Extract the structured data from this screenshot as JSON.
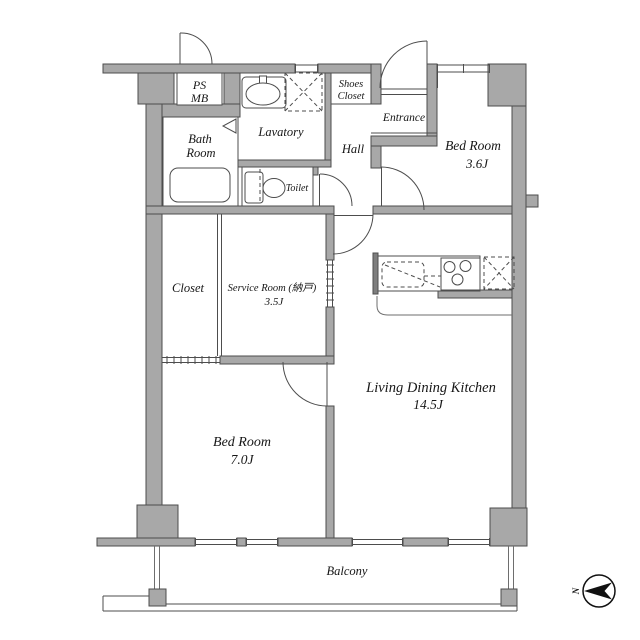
{
  "colors": {
    "wall_fill": "#a8a8a8",
    "wall_edge": "#4d4d4d",
    "counter_bar": "#7e7e7e",
    "text": "#161616",
    "compass": "#111111"
  },
  "rooms": {
    "ps_mb": {
      "line1": "PS",
      "line2": "MB"
    },
    "bath": {
      "line1": "Bath",
      "line2": "Room"
    },
    "lavatory": {
      "label": "Lavatory"
    },
    "shoes_closet": {
      "line1": "Shoes",
      "line2": "Closet"
    },
    "hall": {
      "label": "Hall"
    },
    "entrance": {
      "label": "Entrance"
    },
    "toilet": {
      "label": "Toilet"
    },
    "bedroom_3_6": {
      "line1": "Bed Room",
      "line2": "3.6J"
    },
    "closet": {
      "label": "Closet"
    },
    "service_room": {
      "line1": "Service Room (納戸)",
      "line2": "3.5J"
    },
    "ldk": {
      "line1": "Living Dining Kitchen",
      "line2": "14.5J"
    },
    "bedroom_7_0": {
      "line1": "Bed Room",
      "line2": "7.0J"
    },
    "balcony": {
      "label": "Balcony"
    }
  },
  "compass": {
    "label": "N"
  }
}
